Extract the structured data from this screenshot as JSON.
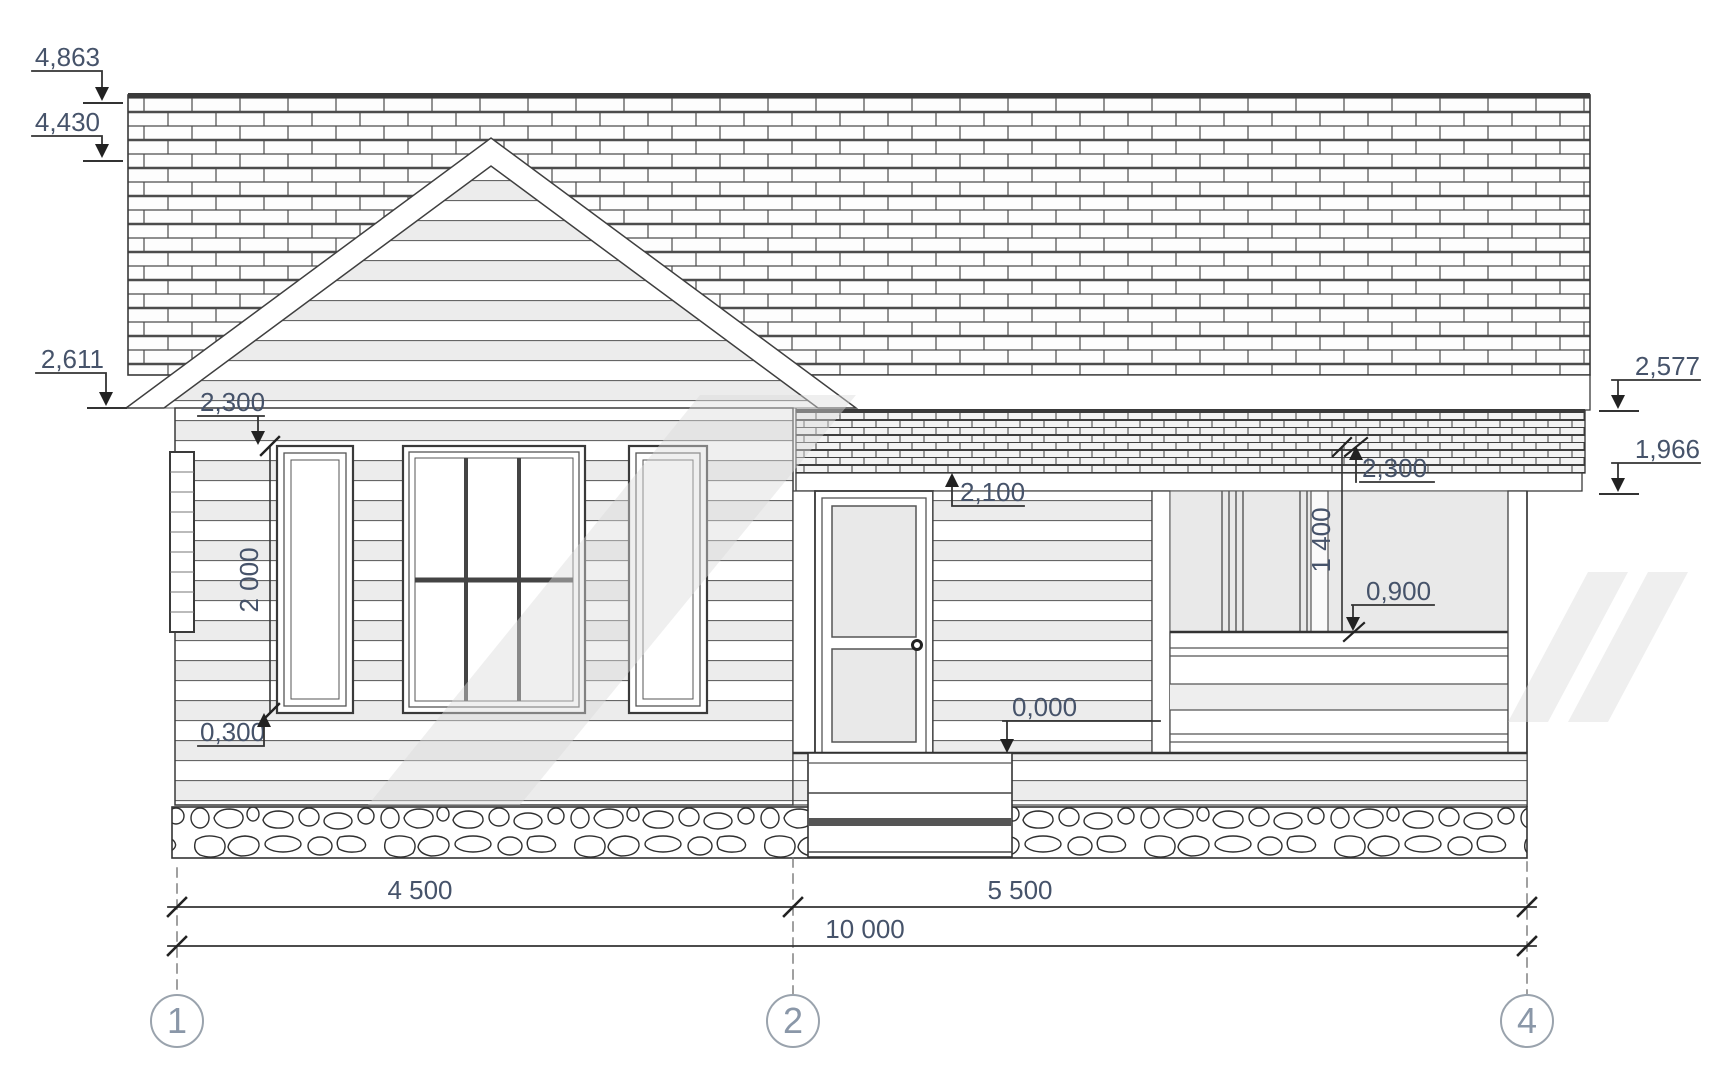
{
  "drawing_type": "house-front-elevation",
  "labels": {
    "ridge": "4,863",
    "gable_peak": "4,430",
    "eave_left": "2,611",
    "bay_window_head": "2,300",
    "bay_window_height": "2 000",
    "bay_window_sill": "0,300",
    "door_height": "2,100",
    "floor_level": "0,000",
    "veranda_ceiling": "2,300",
    "veranda_opening_height": "1 400",
    "railing_height": "0,900",
    "eave_right": "2,577",
    "porch_roof_lower_edge": "1,966",
    "span_1_2": "4 500",
    "span_2_4": "5 500",
    "overall_width": "10 000",
    "axis_1": "1",
    "axis_2": "2",
    "axis_4": "4"
  },
  "colors": {
    "line": "#3b3b3b",
    "dimension_text": "#46536a",
    "axis_bubble_text": "#8a97a8",
    "siding_shade": "#ececec",
    "opening_fill": "#e9e9e9"
  }
}
